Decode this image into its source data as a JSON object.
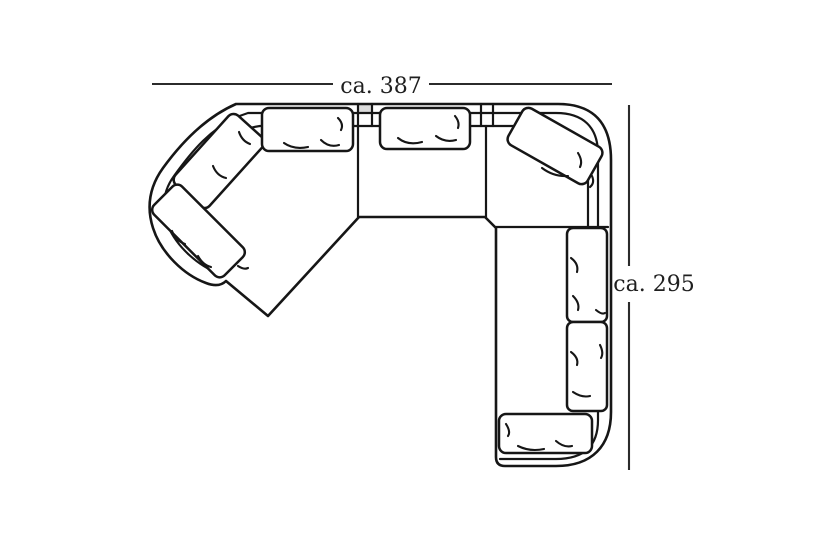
{
  "figure": {
    "type": "furniture-top-view-dimension-diagram",
    "subject": "corner-sofa",
    "dimensions": {
      "width": {
        "label": "ca. 387"
      },
      "depth": {
        "label": "ca. 295"
      }
    }
  },
  "colors": {
    "background": "#ffffff",
    "line": "#161616",
    "dim_line": "#2b2b2b",
    "label_text": "#1f1f1f",
    "gap_fill": "#dcdcdc"
  }
}
